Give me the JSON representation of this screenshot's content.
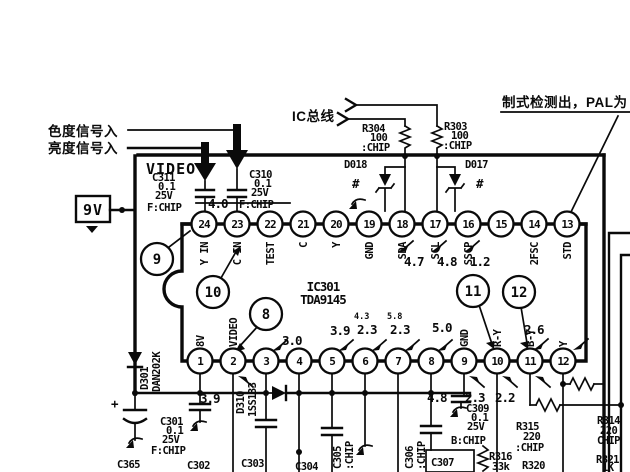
{
  "annotations": {
    "chroma_in": "色度信号入",
    "luma_in": "亮度信号入",
    "ic_bus": "IC总线",
    "standard_detect": "制式检测出，PAL为",
    "supply_9v": "9V",
    "module_name": "VIDEO",
    "line_voltage": "4.0"
  },
  "ic": {
    "ref": "IC301",
    "part": "TDA9145"
  },
  "pins_top": [
    {
      "num": "24",
      "name": "Y IN"
    },
    {
      "num": "23",
      "name": "C IN"
    },
    {
      "num": "22",
      "name": "TEST"
    },
    {
      "num": "21",
      "name": "C"
    },
    {
      "num": "20",
      "name": "Y"
    },
    {
      "num": "19",
      "name": "GND"
    },
    {
      "num": "18",
      "name": "SDA",
      "volt": "4.7"
    },
    {
      "num": "17",
      "name": "SCL",
      "volt": "4.8"
    },
    {
      "num": "16",
      "name": "SSCP",
      "volt": "1.2"
    },
    {
      "num": "15",
      "name": ""
    },
    {
      "num": "14",
      "name": "2FSC"
    },
    {
      "num": "13",
      "name": "STD"
    }
  ],
  "pins_bottom": [
    {
      "num": "1",
      "name": "8V"
    },
    {
      "num": "2",
      "name": "VIDEO",
      "volt_below": "3.9"
    },
    {
      "num": "3",
      "volt": "3.0"
    },
    {
      "num": "4"
    },
    {
      "num": "5",
      "volt": "3.9"
    },
    {
      "num": "6",
      "volt": "2.3",
      "volt_alt": "4.3"
    },
    {
      "num": "7",
      "volt": "2.3",
      "volt_alt": "5.8"
    },
    {
      "num": "8",
      "volt": "5.0"
    },
    {
      "num": "9",
      "name": "GND",
      "volt_below": "4.8"
    },
    {
      "num": "10",
      "name": "R-Y",
      "volt_below": "2.3"
    },
    {
      "num": "11",
      "name": "B-Y",
      "volt": "2.6",
      "volt_below": "2.2"
    },
    {
      "num": "12",
      "name": "Y"
    }
  ],
  "balloons": {
    "b8": "8",
    "b9": "9",
    "b10": "10",
    "b11": "11",
    "b12": "12"
  },
  "components": {
    "r304": {
      "ref": "R304",
      "value": "100",
      "mount": ":CHIP"
    },
    "r303": {
      "ref": "R303",
      "value": "100",
      "mount": ":CHIP"
    },
    "d018": {
      "ref": "D018",
      "mark": "#"
    },
    "d017": {
      "ref": "D017",
      "mark": "#"
    },
    "c311": {
      "ref": "C311",
      "value": "0.1",
      "voltage": "25V",
      "mount": "F:CHIP"
    },
    "c310": {
      "ref": "C310",
      "value": "0.1",
      "voltage": "25V",
      "mount": "F:CHIP"
    },
    "d301": {
      "ref": "D301",
      "part": "DAN202K"
    },
    "c365": {
      "ref": "C365",
      "polarity": "+"
    },
    "c301": {
      "ref": "C301",
      "value": "0.1",
      "voltage": "25V",
      "mount": "F:CHIP"
    },
    "c302": {
      "ref": "C302"
    },
    "d310": {
      "ref": "D310",
      "part": "1SS133"
    },
    "c303": {
      "ref": "C303"
    },
    "c304": {
      "ref": "C304"
    },
    "c305": {
      "ref": "C305",
      "mount": ":CHIP"
    },
    "c306": {
      "ref": "C306",
      "mount": ":CHIP"
    },
    "c307": {
      "ref": "C307"
    },
    "c309": {
      "ref": "C309",
      "value": "0.1",
      "voltage": "25V",
      "mount": "B:CHIP"
    },
    "r316": {
      "ref": "R316",
      "value": "33k"
    },
    "r320": {
      "ref": "R320"
    },
    "r315": {
      "ref": "R315",
      "value": "220",
      "mount": ":CHIP"
    },
    "r314": {
      "ref": "R314",
      "value": "220",
      "mount": "CHIP"
    },
    "r321": {
      "ref": "R321",
      "value": "1K"
    }
  }
}
